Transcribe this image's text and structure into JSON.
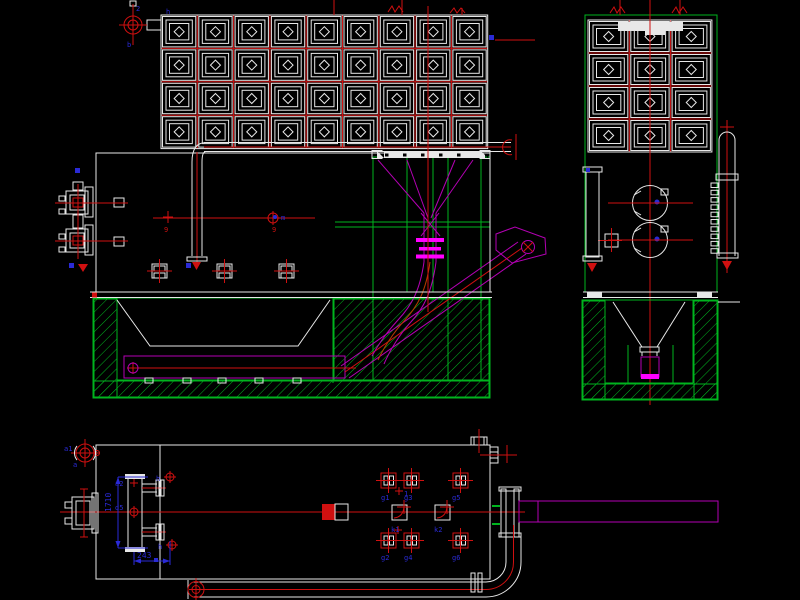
{
  "canvas": {
    "width": 800,
    "height": 600,
    "background": "#000000"
  },
  "colors": {
    "white": "#e8e8e8",
    "red": "#d01010",
    "green": "#00b41e",
    "magenta": "#b400b4",
    "bright_magenta": "#ff00ff",
    "blue": "#2a2ad6",
    "orange": "#b43c00",
    "black": "#000000"
  },
  "views": {
    "front": {
      "name": "front-elevation",
      "filter_grid": {
        "cols": 9,
        "rows": 4
      }
    },
    "side": {
      "name": "side-elevation",
      "filter_grid": {
        "cols": 3,
        "rows": 4
      }
    },
    "plan": {
      "name": "plan-view"
    }
  },
  "dimensions": [
    {
      "text": "1710"
    },
    {
      "text": "243"
    }
  ],
  "labels": [
    {
      "text": "2",
      "x": 136,
      "y": 11,
      "c": "blue"
    },
    {
      "text": "b",
      "x": 127,
      "y": 47,
      "c": "blue"
    },
    {
      "text": "h",
      "x": 166,
      "y": 14,
      "c": "blue"
    },
    {
      "text": "m",
      "x": 281,
      "y": 220,
      "c": "blue"
    },
    {
      "text": "9",
      "x": 164,
      "y": 232,
      "c": "red"
    },
    {
      "text": "9",
      "x": 272,
      "y": 232,
      "c": "red"
    },
    {
      "text": "a1",
      "x": 64,
      "y": 451,
      "c": "blue"
    },
    {
      "text": "a",
      "x": 73,
      "y": 467,
      "c": "blue"
    },
    {
      "text": "a2",
      "x": 115,
      "y": 486,
      "c": "blue"
    },
    {
      "text": "d5",
      "x": 115,
      "y": 510,
      "c": "blue"
    },
    {
      "text": "h",
      "x": 156,
      "y": 481,
      "c": "blue"
    },
    {
      "text": "h",
      "x": 158,
      "y": 549,
      "c": "blue"
    },
    {
      "text": "1710",
      "x": 111,
      "y": 512,
      "c": "blue",
      "size": 8,
      "rot": -90
    },
    {
      "text": "243",
      "x": 137,
      "y": 558,
      "c": "blue",
      "size": 8
    },
    {
      "text": "g1",
      "x": 381,
      "y": 500,
      "c": "blue"
    },
    {
      "text": "g3",
      "x": 404,
      "y": 500,
      "c": "blue"
    },
    {
      "text": "g5",
      "x": 452,
      "y": 500,
      "c": "blue"
    },
    {
      "text": "g2",
      "x": 381,
      "y": 560,
      "c": "blue"
    },
    {
      "text": "g4",
      "x": 404,
      "y": 560,
      "c": "blue"
    },
    {
      "text": "g6",
      "x": 452,
      "y": 560,
      "c": "blue"
    },
    {
      "text": "k1",
      "x": 391,
      "y": 532,
      "c": "blue"
    },
    {
      "text": "k2",
      "x": 434,
      "y": 532,
      "c": "blue"
    },
    {
      "text": "1",
      "x": 404,
      "y": 496,
      "c": "blue"
    }
  ],
  "markers": [
    [
      489,
      35,
      5
    ],
    [
      75,
      168,
      5
    ],
    [
      69,
      263,
      5
    ],
    [
      186,
      263,
      5
    ],
    [
      586,
      168,
      4
    ],
    [
      154,
      558,
      4
    ]
  ]
}
